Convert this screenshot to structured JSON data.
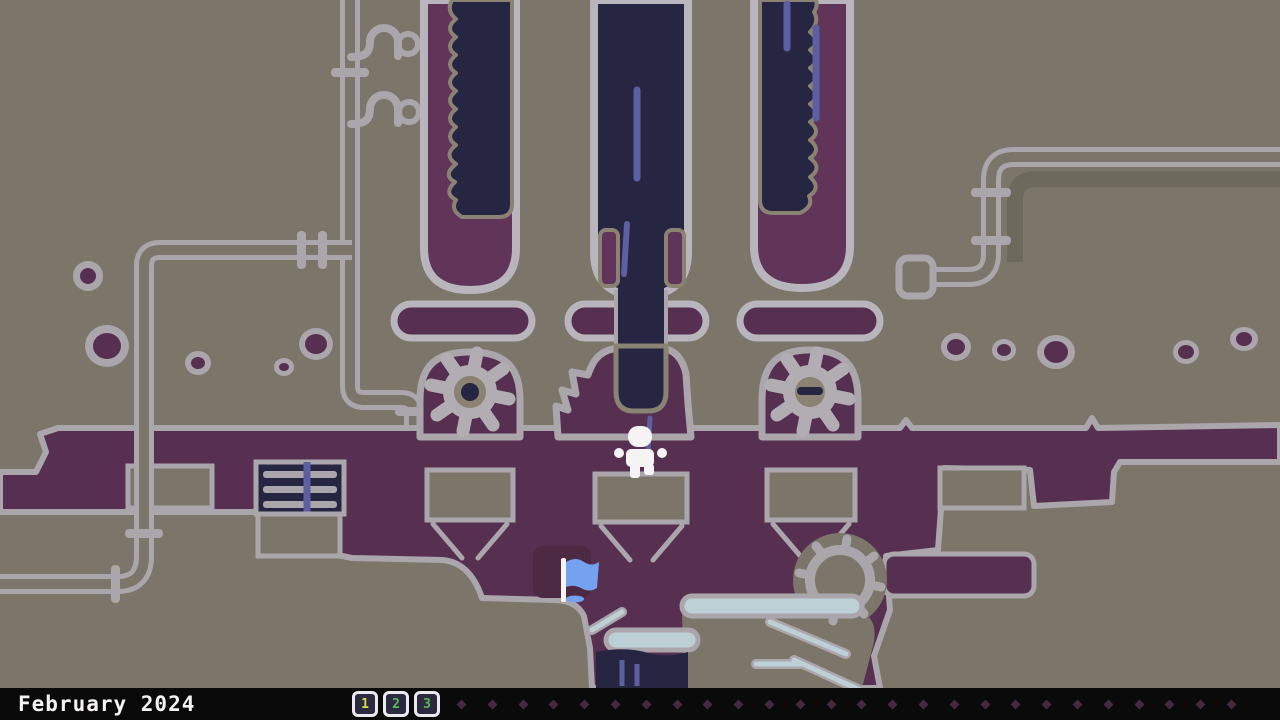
{
  "hud": {
    "date_label": "February 2024",
    "day_badges": [
      {
        "label": "1",
        "color": "#d6dc4b"
      },
      {
        "label": "2",
        "color": "#56bb58"
      },
      {
        "label": "3",
        "color": "#56bb58"
      }
    ],
    "remaining_day_dots": 26
  },
  "theme": {
    "bg": "#7b7669",
    "bg_shadow": "#6e695d",
    "steel": "#aba6ac",
    "steel_light": "#b9b5bd",
    "tube_border": "#8a8373",
    "maroon": "#573051",
    "maroon_bright": "#613459",
    "maroon_deep": "#4d2a44",
    "navy": "#272642",
    "streak": "#5c60a0",
    "flag_blue": "#74a2ef",
    "pale": "#bcd0d6",
    "white": "#f5f3f4",
    "bar_bg": "#0a0a0a",
    "badge_bg": "#2b2a3e",
    "badge_border": "#eceaf0",
    "dot": "#452a3d",
    "gear": "#b2adb3",
    "gear_center": "#8b8273"
  },
  "scene_objects": {
    "player": "player-character",
    "flag": "checkpoint-flag",
    "gears": 2,
    "test_tubes": 3,
    "platform_lozenges": 3
  }
}
